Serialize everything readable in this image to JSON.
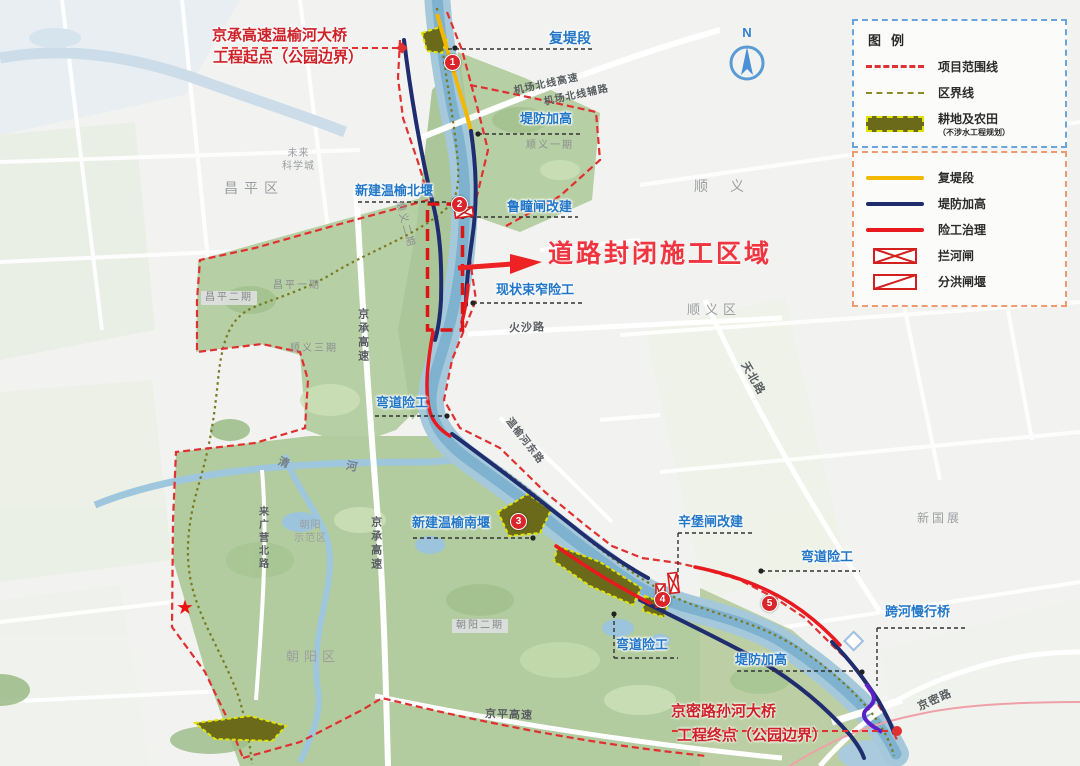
{
  "annotations": {
    "start": {
      "line1": "京承高速温榆河大桥",
      "line2": "工程起点（公园边界）"
    },
    "end": {
      "line1": "京密路孙河大桥",
      "line2": "工程终点（公园边界）"
    },
    "closure": "道路封闭施工区域"
  },
  "features": [
    {
      "text": "复堤段"
    },
    {
      "text": "堤防加高"
    },
    {
      "text": "新建温榆北堰"
    },
    {
      "text": "鲁疃闸改建"
    },
    {
      "text": "现状束窄险工"
    },
    {
      "text": "弯道险工"
    },
    {
      "text": "新建温榆南堰"
    },
    {
      "text": "辛堡闸改建"
    },
    {
      "text": "弯道险工"
    },
    {
      "text": "跨河慢行桥"
    },
    {
      "text": "弯道险工"
    },
    {
      "text": "堤防加高"
    }
  ],
  "regions": [
    {
      "text": "昌平区"
    },
    {
      "text": "顺义"
    },
    {
      "text": "顺义区"
    },
    {
      "text": "朝阳区"
    },
    {
      "text": "新国展"
    },
    {
      "line1": "未来",
      "line2": "科学城"
    },
    {
      "line1": "朝阳",
      "line2": "示范区"
    },
    {
      "text": "昌平二期"
    },
    {
      "text": "昌平一期"
    },
    {
      "text": "顺义三期"
    },
    {
      "text": "顺义一期"
    },
    {
      "text": "顺义二期"
    },
    {
      "text": "朝阳二期"
    }
  ],
  "roads": [
    {
      "text": "机场北线高速"
    },
    {
      "text": "机场北线辅路"
    },
    {
      "text": "火沙路"
    },
    {
      "text": "天北路"
    },
    {
      "text": "京承高速"
    },
    {
      "text": "京承高速"
    },
    {
      "text": "来广营北路"
    },
    {
      "text": "京平高速"
    },
    {
      "text": "京密路"
    },
    {
      "text": "温榆河东路"
    }
  ],
  "waters": [
    {
      "text": "清"
    },
    {
      "text": "河"
    }
  ],
  "markers": [
    "1",
    "2",
    "3",
    "4",
    "5"
  ],
  "compass": "N",
  "icons": {
    "star": "★"
  },
  "legend": {
    "title": "图例",
    "boundary_items": [
      {
        "label": "项目范围线"
      },
      {
        "label": "区界线"
      },
      {
        "label": "耕地及农田",
        "note": "（不涉水工程规划）"
      }
    ],
    "work_items": [
      {
        "label": "复堤段"
      },
      {
        "label": "堤防加高"
      },
      {
        "label": "险工治理"
      },
      {
        "label": "拦河闸"
      },
      {
        "label": "分洪闸堰"
      }
    ]
  },
  "colors": {
    "project_boundary": "#e03030",
    "district_boundary": "#8a8a2a",
    "farmland": "#6a6a1a",
    "re_embankment": "#f5b800",
    "dike_raising": "#1f2d6e",
    "risk_treatment": "#e8191f",
    "river": "#8fb9d2",
    "annotation_red": "#cf2128",
    "feature_blue": "#2176c7"
  }
}
